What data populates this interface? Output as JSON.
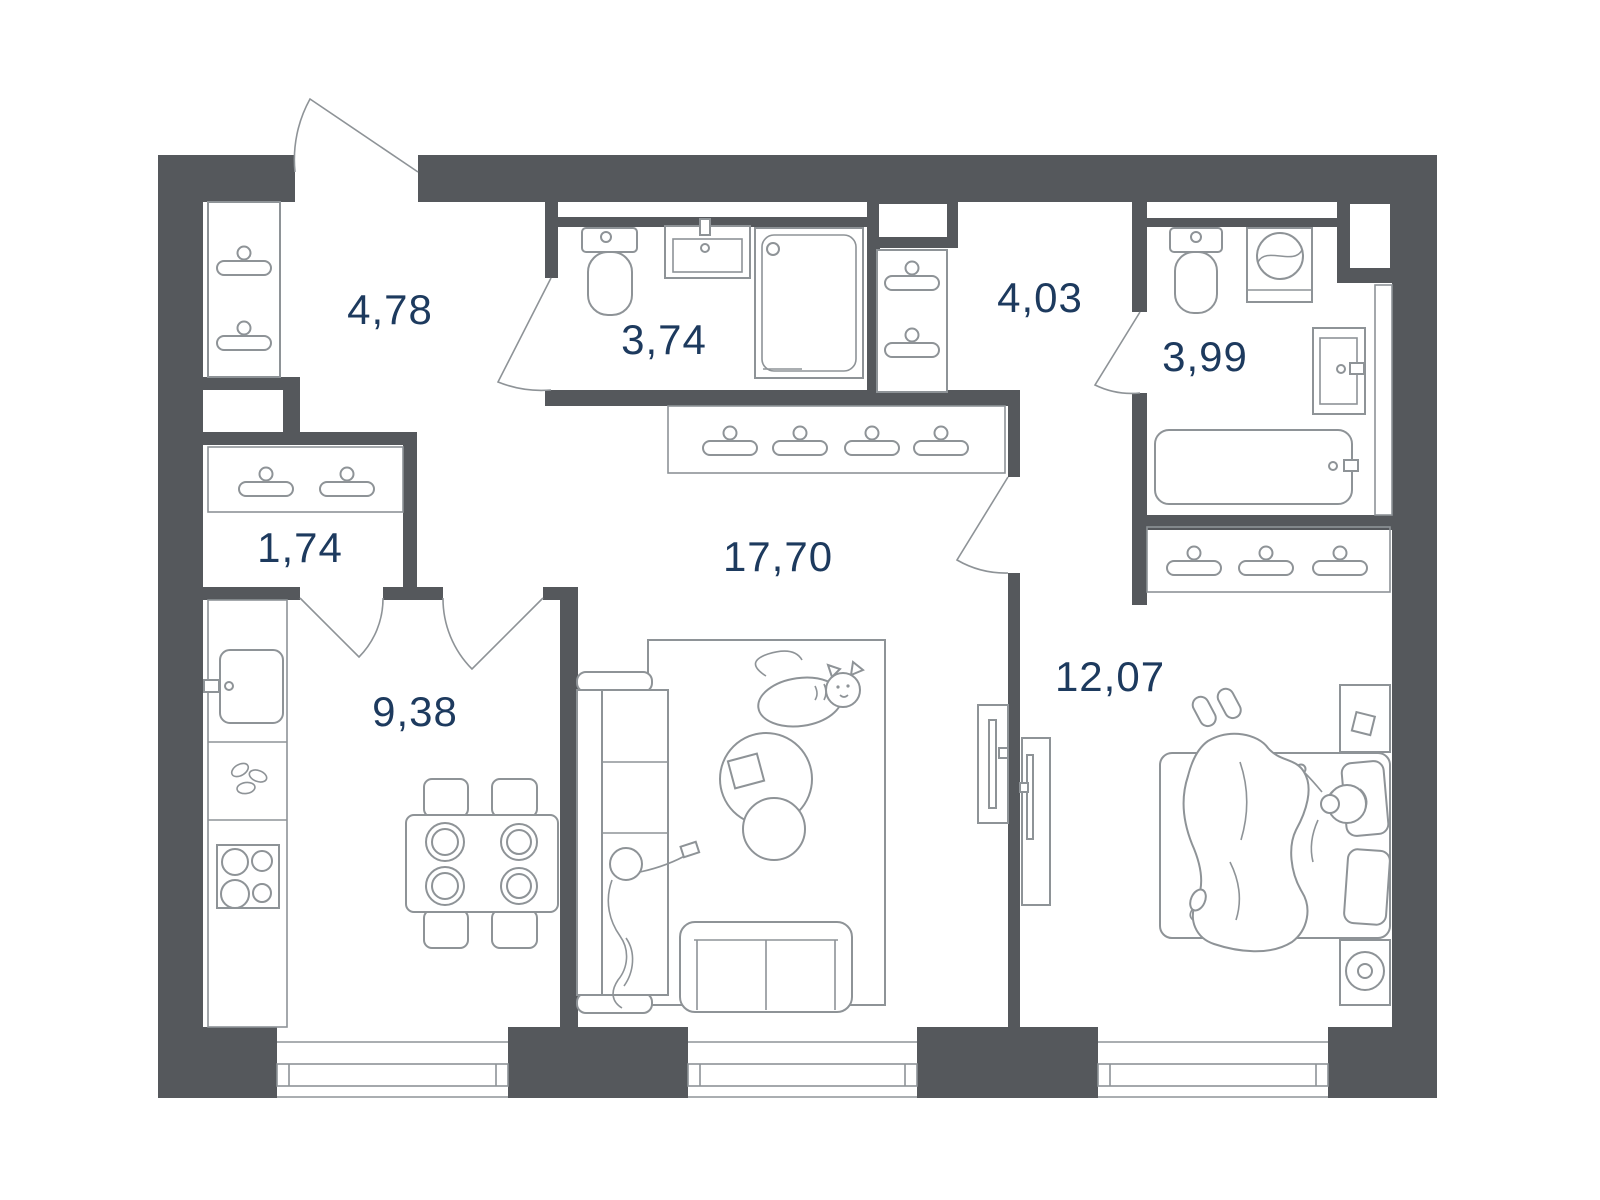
{
  "colors": {
    "wall": "#55585c",
    "line": "#8e9397",
    "label": "#1d3a5e",
    "background": "#ffffff"
  },
  "rooms": [
    {
      "name": "entry-hall",
      "area": "4,78"
    },
    {
      "name": "bathroom-guest",
      "area": "3,74"
    },
    {
      "name": "hallway",
      "area": "4,03"
    },
    {
      "name": "bathroom-main",
      "area": "3,99"
    },
    {
      "name": "closet",
      "area": "1,74"
    },
    {
      "name": "living-room",
      "area": "17,70"
    },
    {
      "name": "kitchen",
      "area": "9,38"
    },
    {
      "name": "bedroom",
      "area": "12,07"
    }
  ],
  "fixtures": [
    "hanger-icon",
    "toilet-icon",
    "washbasin-icon",
    "shower-cabin-icon",
    "bathtub-icon",
    "washing-machine-icon",
    "kitchen-sink-icon",
    "stove-icon",
    "dining-table-icon",
    "chair-icon",
    "plate-icon",
    "sofa-icon",
    "couch-icon",
    "coffee-table-icon",
    "rug-icon",
    "tv-console-icon",
    "bed-icon",
    "pillow-icon",
    "nightstand-icon",
    "speaker-icon",
    "slippers-icon",
    "cat-icon",
    "person-icon",
    "door-icon",
    "window-icon"
  ]
}
